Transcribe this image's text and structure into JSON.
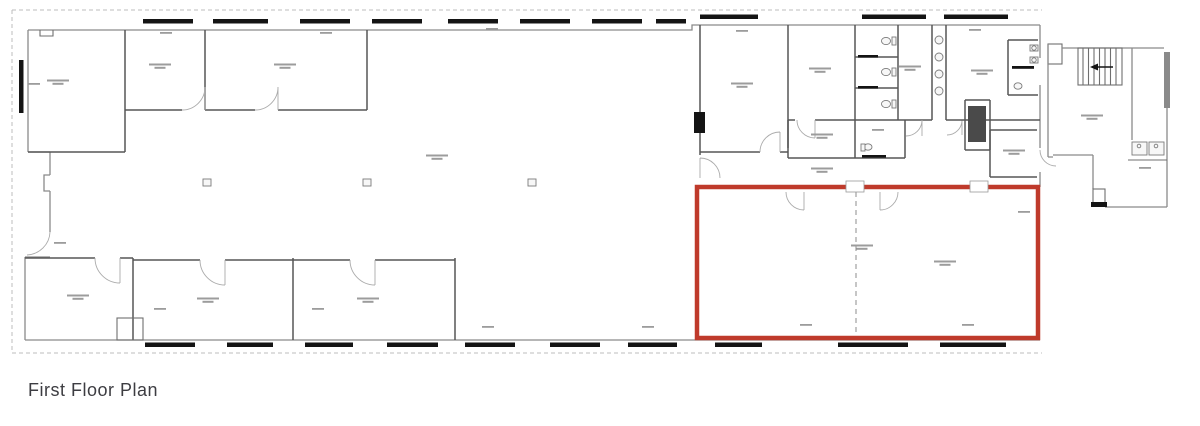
{
  "page": {
    "background": "#ffffff"
  },
  "caption": {
    "text": "First Floor Plan",
    "color": "#3d3d42"
  },
  "plan": {
    "highlight_color": "#bf3a2b",
    "wall_color": "#8a8a8a",
    "window_color": "#141414",
    "room_label_color": "#9c9c9c",
    "room_labels_legible": "false"
  }
}
